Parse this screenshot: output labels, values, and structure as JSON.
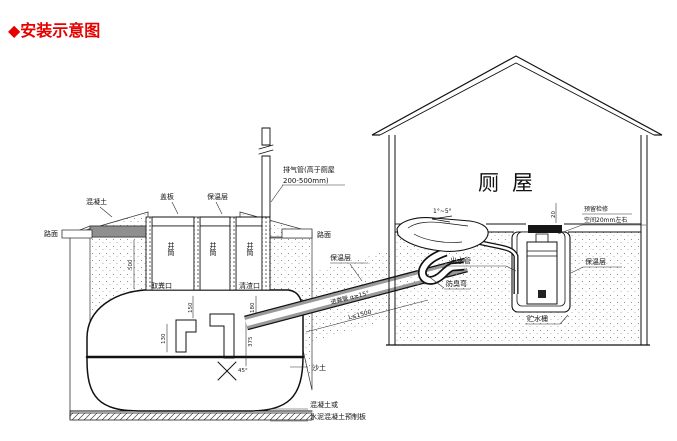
{
  "title": {
    "text": "◆安装示意图"
  },
  "colors": {
    "title_red": "#e60000",
    "slab_gray": "#8f8f8f",
    "pipe_gray": "#9a9a9a",
    "line": "#1a1a1a"
  },
  "tank": {
    "concrete_label": "混凝土",
    "road_left": "路面",
    "road_right": "路面",
    "cover_plate": "盖板",
    "insulation": "保温层",
    "shafts": [
      "井筒",
      "井筒",
      "井筒"
    ],
    "fecal_port": "取粪口",
    "slag_port": "清渣口",
    "sand": "沙土",
    "base_note_line1": "混凝土或",
    "base_note_line2": "水泥混凝土预制板"
  },
  "vent": {
    "line1": "排气管(高于厕屋",
    "line2": "200-500mm)"
  },
  "inlet_pipe": {
    "insulation": "保温层",
    "name": "进粪管 α≥15°",
    "length": "L≤1500"
  },
  "house": {
    "name": "厕屋",
    "slope": "1°~5°",
    "service_line1": "预留检修",
    "service_line2": "空间20mm左右",
    "outlet_pipe": "出水管",
    "odor_trap": "防臭弯",
    "insulation": "保温层",
    "water_bucket": "贮水桶"
  },
  "dims": {
    "tank_depth": "500",
    "baffle_a": "150",
    "baffle_b": "130",
    "baffle_c": "375",
    "angle": "45°",
    "pipe_drop": "180",
    "gap": "20"
  }
}
